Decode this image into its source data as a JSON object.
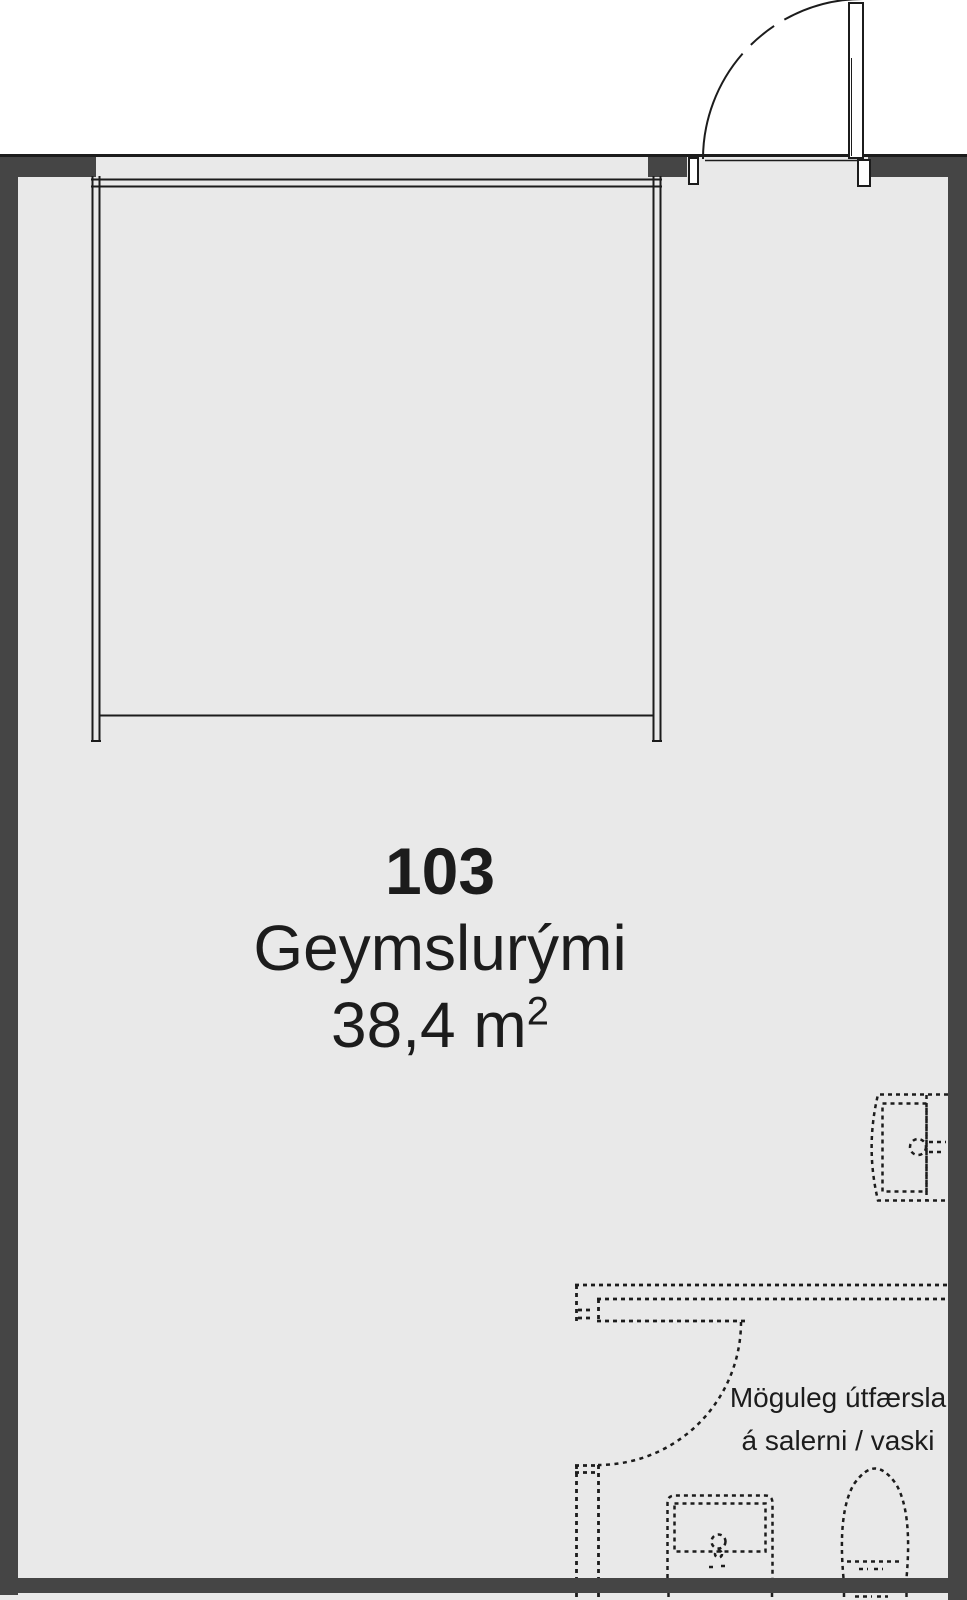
{
  "palette": {
    "wall": "#454545",
    "line": "#1c1c1c",
    "floor": "#e9e9e9",
    "outside": "#ffffff"
  },
  "room": {
    "number": "103",
    "name": "Geymslurými",
    "area_value": "38,4 m",
    "area_superscript": "2"
  },
  "annotation": {
    "line1": "Möguleg útfærsla",
    "line2": "á salerni / vaski"
  }
}
